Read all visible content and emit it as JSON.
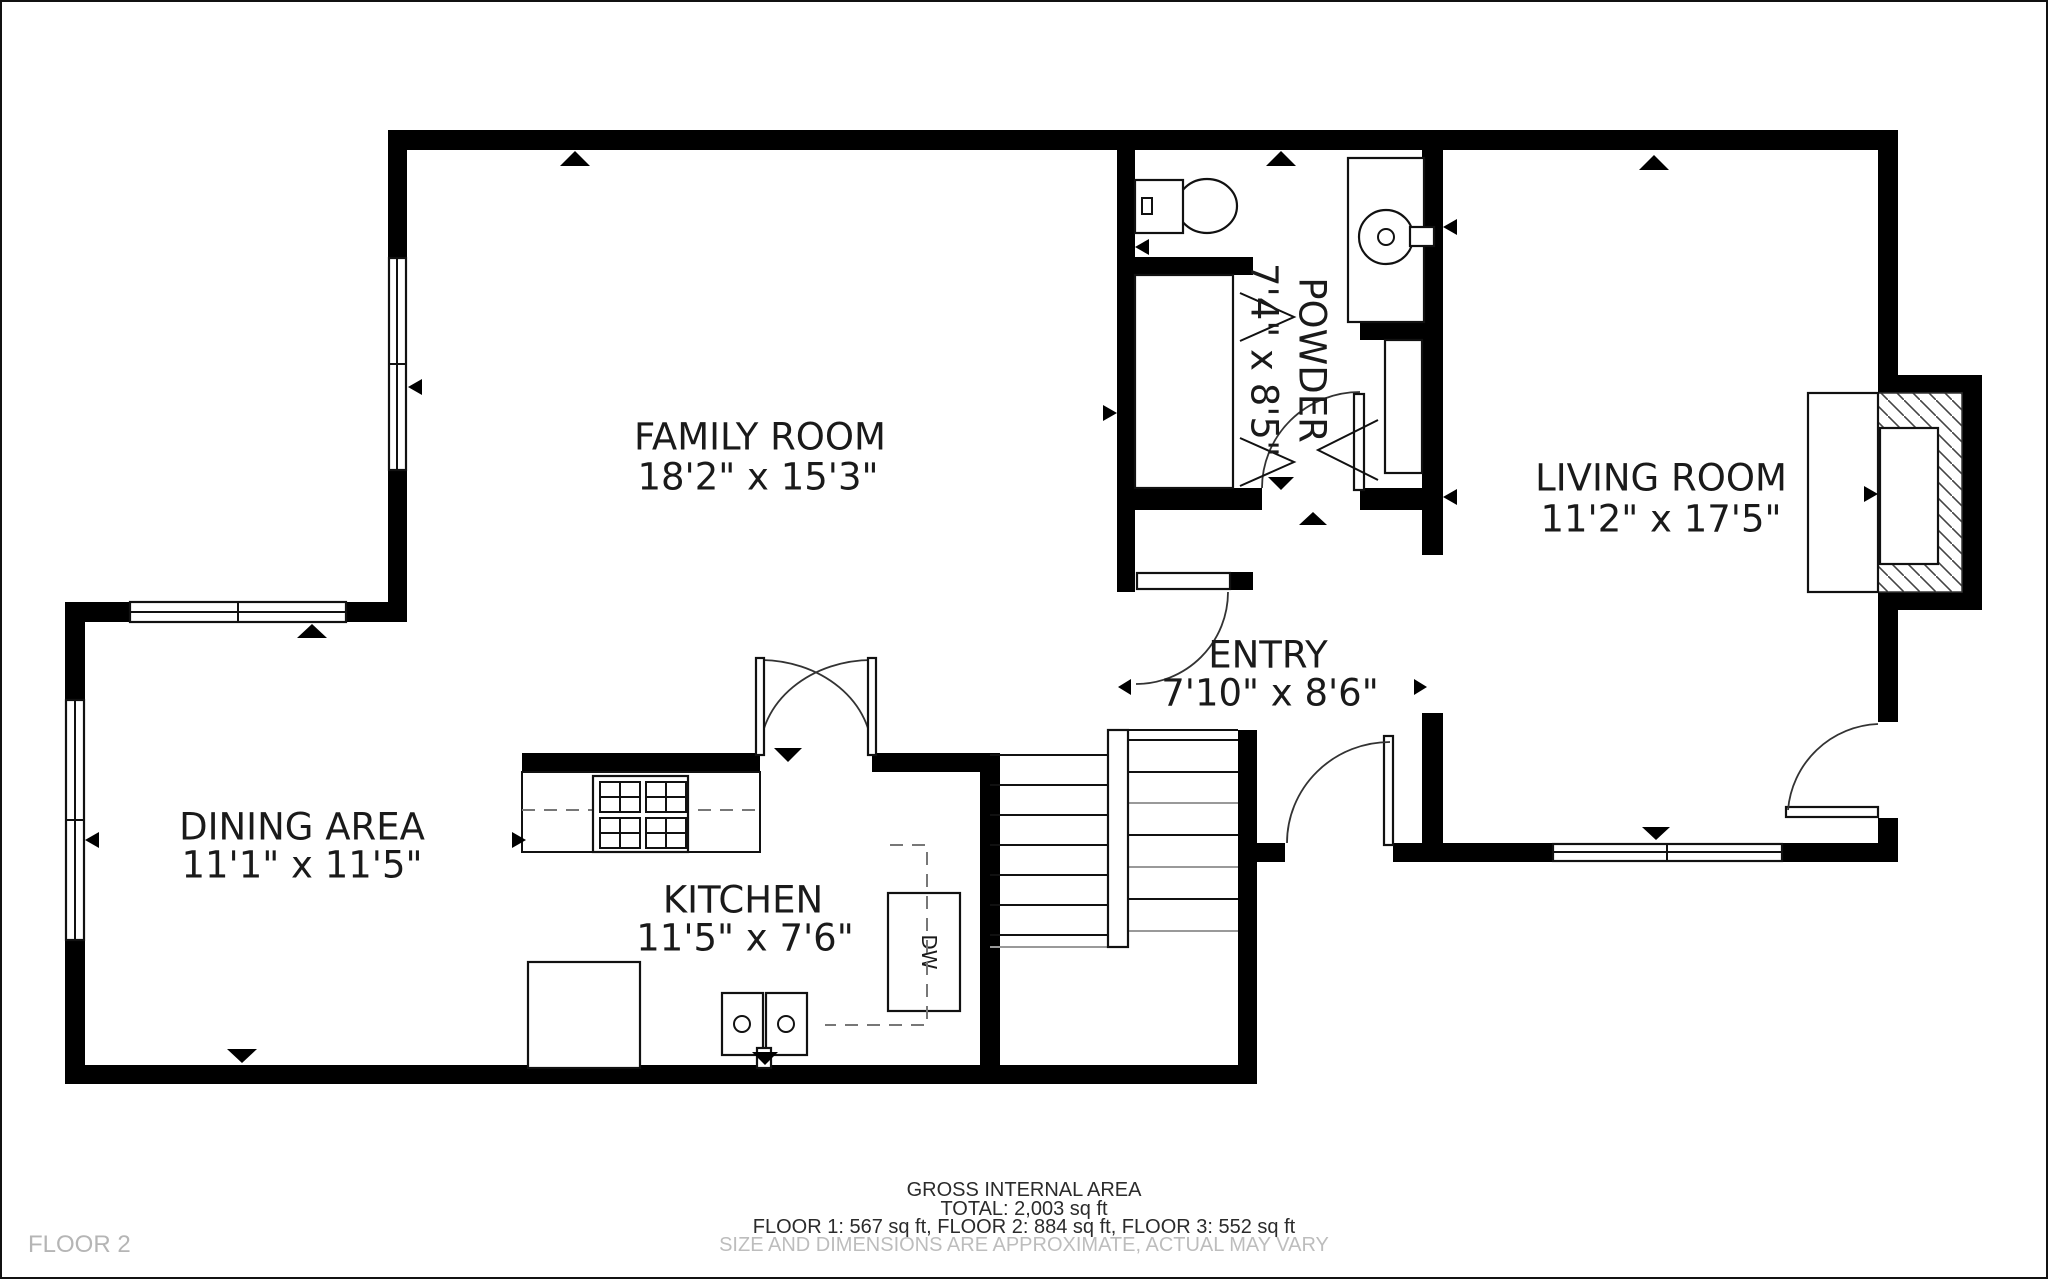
{
  "plan": {
    "floor_label": "FLOOR 2",
    "rooms": {
      "family": {
        "name": "FAMILY ROOM",
        "dims": "18'2\" x 15'3\""
      },
      "dining": {
        "name": "DINING AREA",
        "dims": "11'1\" x 11'5\""
      },
      "kitchen": {
        "name": "KITCHEN",
        "dims": "11'5\" x 7'6\""
      },
      "entry": {
        "name": "ENTRY",
        "dims": "7'10\" x 8'6\""
      },
      "living": {
        "name": "LIVING ROOM",
        "dims": "11'2\" x 17'5\""
      },
      "powder": {
        "name": "POWDER",
        "dims": "7'4\" x 8'5\""
      }
    },
    "appliances": {
      "dishwasher": "DW"
    },
    "footer": {
      "title": "GROSS INTERNAL AREA",
      "total": "TOTAL: 2,003 sq ft",
      "floors": "FLOOR 1: 567 sq ft, FLOOR 2: 884 sq ft, FLOOR 3: 552 sq ft",
      "disclaimer": "SIZE AND DIMENSIONS ARE APPROXIMATE, ACTUAL MAY VARY"
    },
    "colors": {
      "wall": "#000000",
      "muted_text": "#bdbdbd",
      "label_text": "#1a1a1a"
    }
  }
}
